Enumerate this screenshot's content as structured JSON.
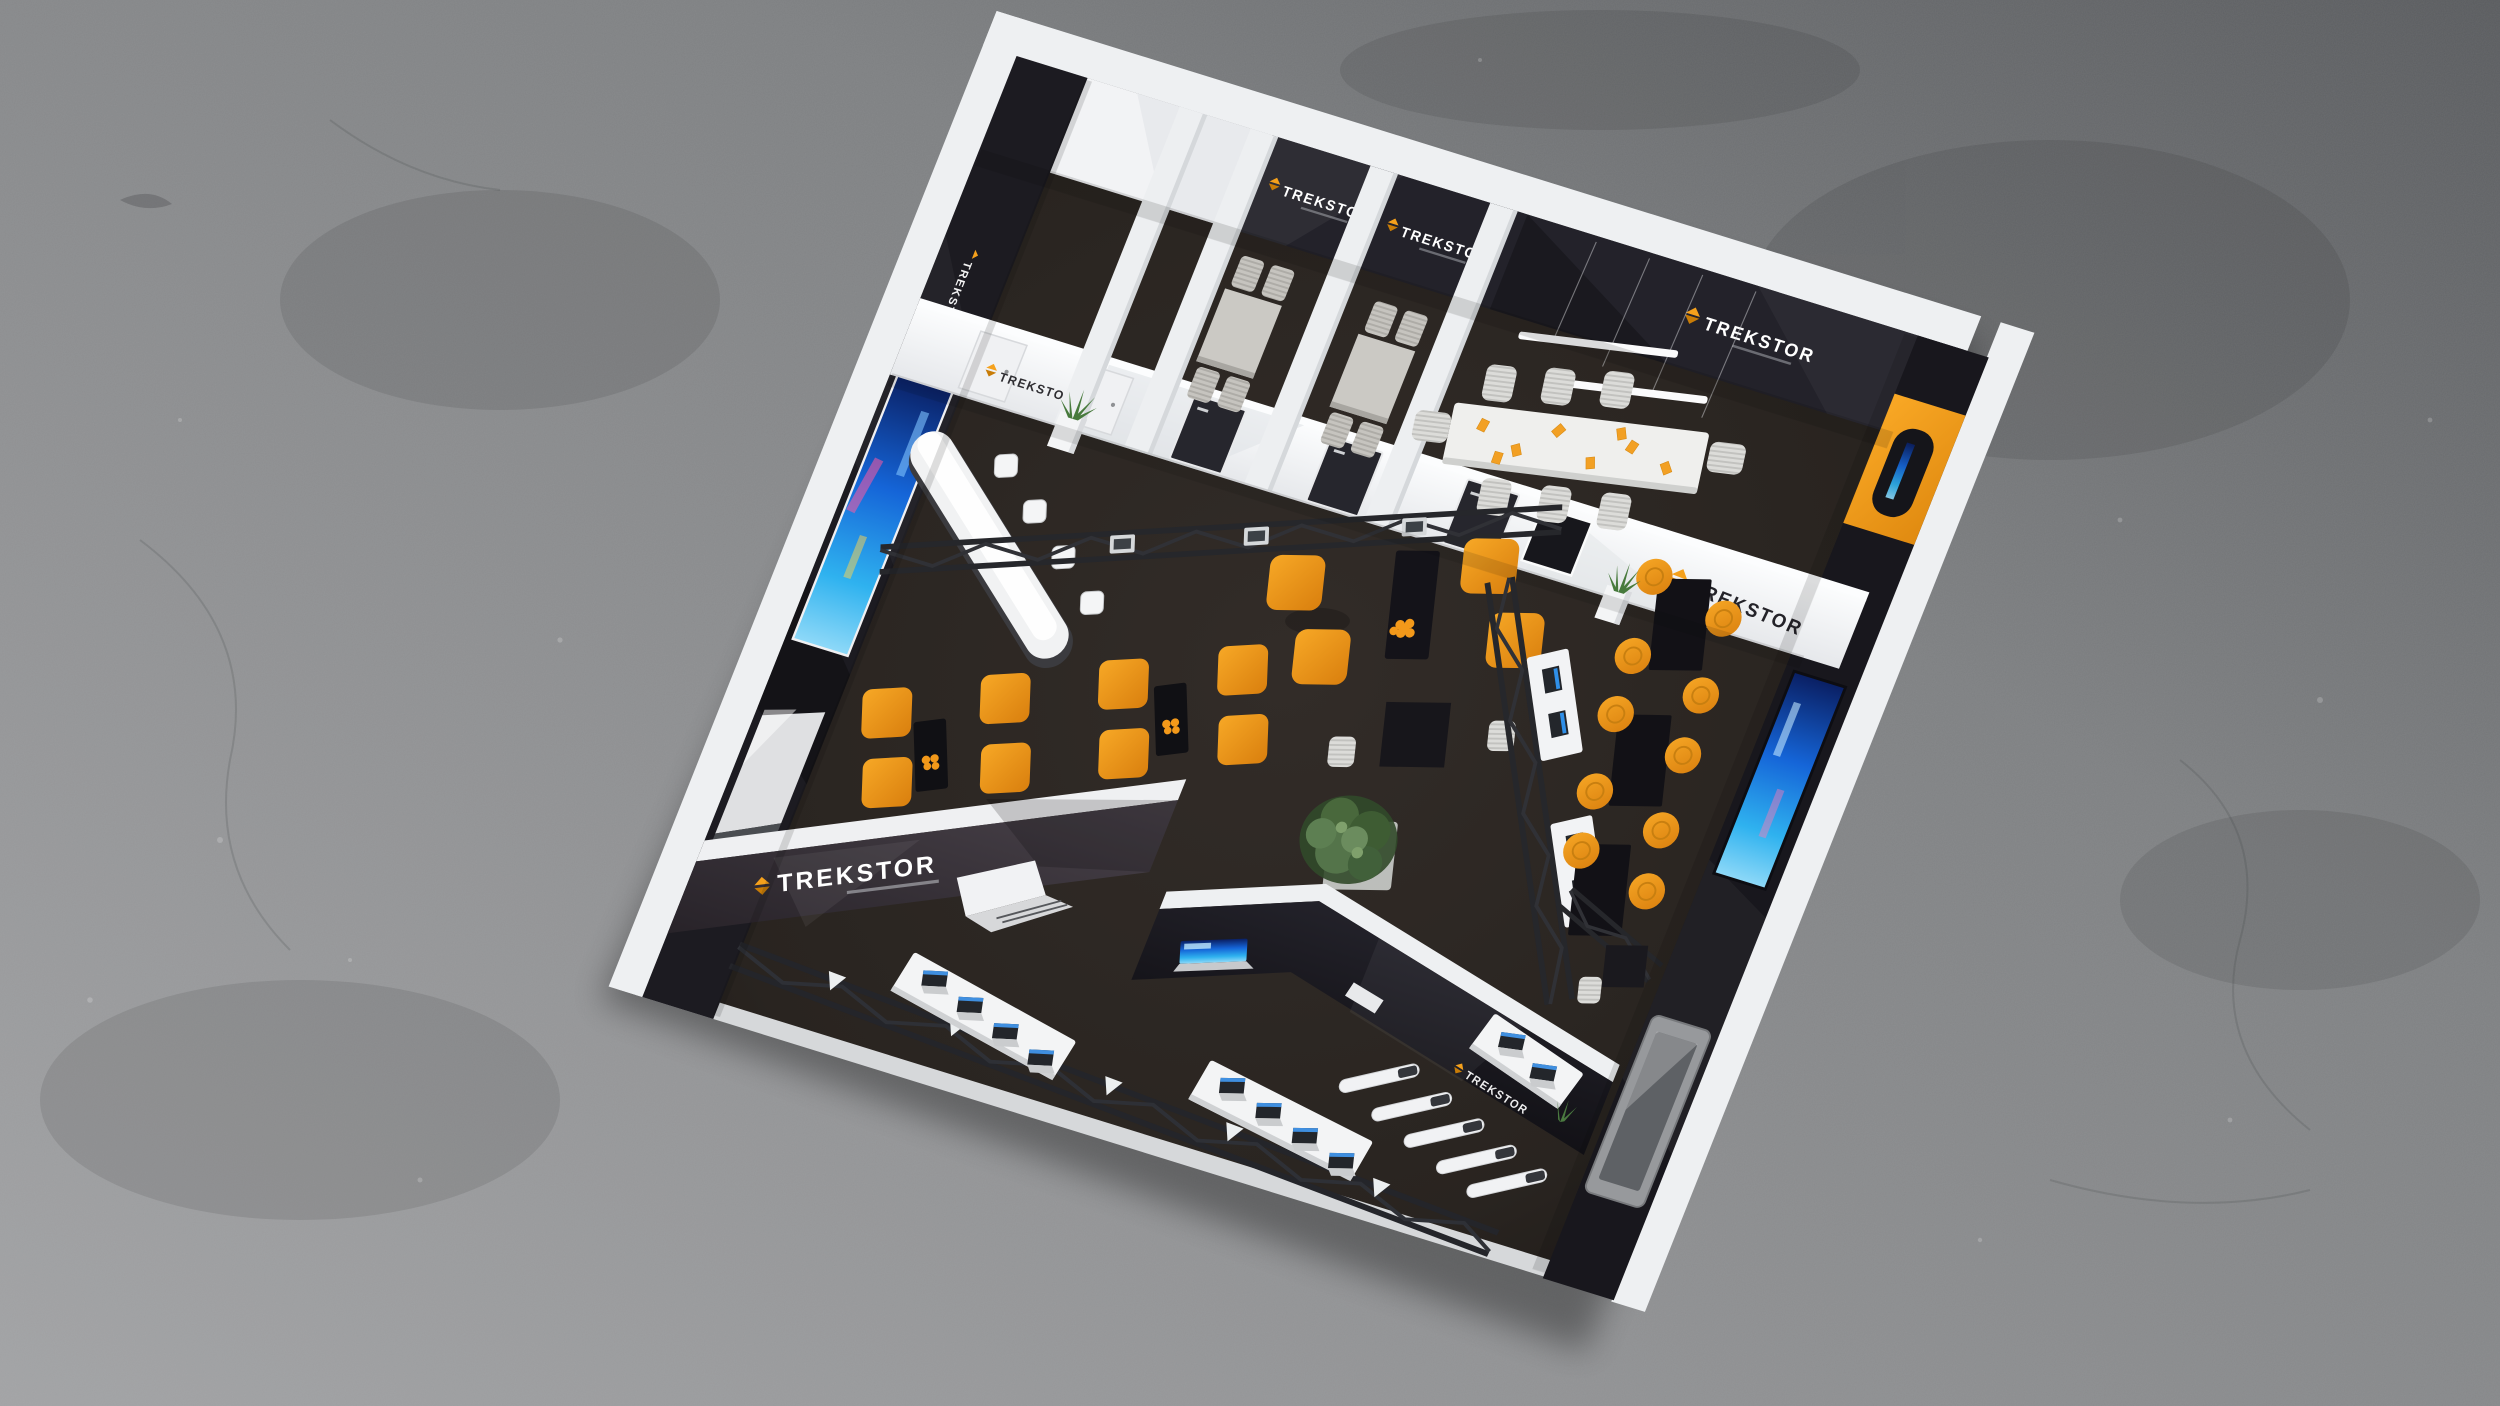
{
  "scene": {
    "kind": "3d-architectural-render",
    "description": "Top-down bird's-eye rendering of a TREKSTOR exhibition booth standing on a gray concrete hall floor",
    "view": "overhead, booth rotated ~17 degrees clockwise"
  },
  "brand": {
    "name": "TREKSTOR",
    "accent_orange": "#F59C1B",
    "wordmark_dark": "#2B2A2E",
    "wordmark_light": "#FFFFFF"
  },
  "palette": {
    "concrete_light": "#9C9DA0",
    "concrete_dark": "#5E6063",
    "carpet": "#2B2724",
    "wall_white": "#F3F4F6",
    "wall_dark": "#1D1C22",
    "diagonal_wall_outer": "#453F46",
    "orange_accent_wall": "#F2991C",
    "screen_blue": "#1E7FE0",
    "truss_gray": "#27282C",
    "table_black": "#141318",
    "chair_orange": "#F0991B",
    "furniture_gray": "#C9C7C2"
  },
  "logos": [
    {
      "location": "meeting-room-1 back wall",
      "style": "white on dark"
    },
    {
      "location": "meeting-room-2 back wall",
      "style": "white on dark"
    },
    {
      "location": "conference-room back wall",
      "style": "white on dark"
    },
    {
      "location": "front wall left (white)",
      "style": "dark on white"
    },
    {
      "location": "conference front wall (white)",
      "style": "dark on white"
    },
    {
      "location": "left outer wall (vertical)",
      "style": "white on dark"
    },
    {
      "location": "diagonal wall south-west",
      "style": "white on dark"
    },
    {
      "location": "chevron wall right arm",
      "style": "white on dark"
    }
  ],
  "rooms": {
    "storage_rooms_white": 2,
    "small_meeting_rooms": {
      "count": 2,
      "chairs_each": 4,
      "table": "gray"
    },
    "conference_room": {
      "chairs": 8,
      "table": "long white",
      "papers_orange": 8,
      "light_bars": 2,
      "accent_wall": "orange with display"
    }
  },
  "furniture": {
    "reception_counter": {
      "shape": "curved white bar",
      "bar_stools": 4
    },
    "lounge": {
      "orange_armchairs": 4,
      "black_coffee_table": 1,
      "orange_bowl": 1
    },
    "seating_rows_orange_chairs": 8,
    "side_tables_black": 2,
    "high_tables_black": 3,
    "orange_stools": 10,
    "center_table_black": 1,
    "white_chairs_center": 2,
    "large_plant": 1,
    "white_planters": 2,
    "display_counters_laptops": [
      4,
      4,
      2
    ],
    "truss_counters_laptops": [
      2,
      2
    ],
    "vertical_display_stands": 5,
    "trusses": {
      "overhead": 2,
      "floor": 1,
      "small": 1
    },
    "doors_dark": 3,
    "doors_white": 2,
    "screens": [
      "left-wall portrait display",
      "right-wall portrait display",
      "orange-wall display",
      "front-wall mounted display",
      "chevron laptop graphic"
    ]
  }
}
